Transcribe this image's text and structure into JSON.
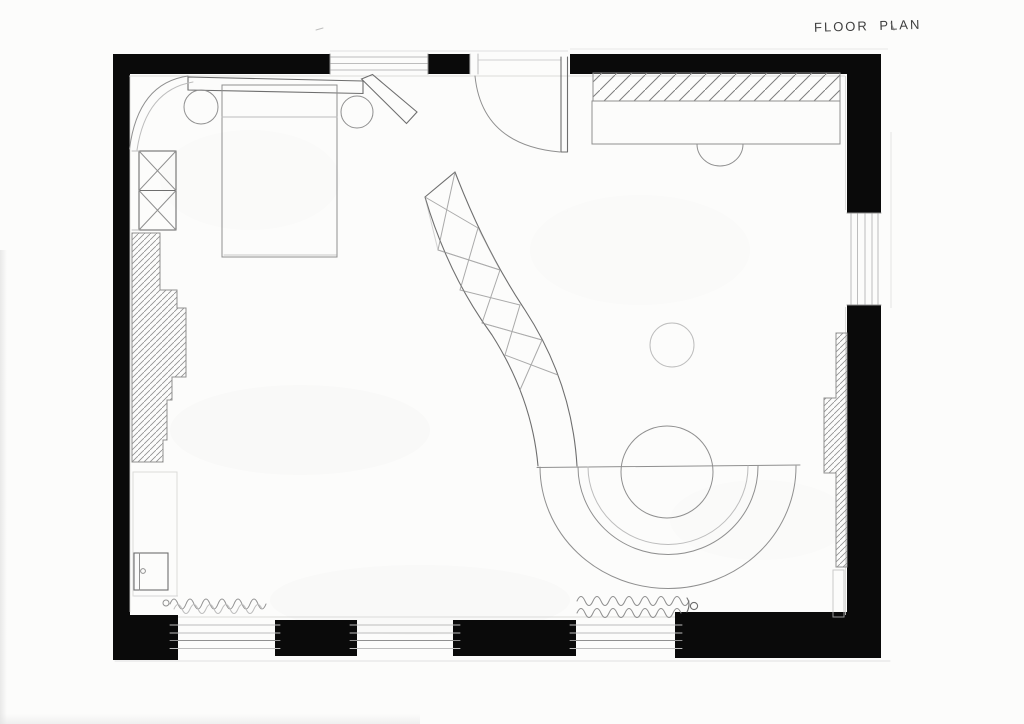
{
  "page": {
    "title_annotation": "FLOOR PLAN"
  },
  "palette": {
    "wall": "#0a0a0a",
    "pencil": "#8f8f8f",
    "pencil_dark": "#6e6e6e",
    "pencil_light": "#bdbdbd",
    "paper": "#fcfcfb",
    "ink": "#3f3f3f"
  },
  "plan": {
    "drawing_type": "hand-drawn pencil floor plan, plan view",
    "elements": [
      {
        "name": "exterior-walls",
        "style": "solid black poche"
      },
      {
        "name": "entry-door",
        "location": "top wall, center, quarter-circle swing"
      },
      {
        "name": "window-top",
        "location": "top wall left of door"
      },
      {
        "name": "window-right",
        "location": "right wall upper"
      },
      {
        "name": "window-bottom-left",
        "location": "bottom wall"
      },
      {
        "name": "window-bottom-center",
        "location": "bottom wall"
      },
      {
        "name": "window-bottom-right",
        "location": "bottom wall"
      },
      {
        "name": "bed",
        "location": "top left"
      },
      {
        "name": "headboard-with-angled-wing",
        "location": "top left"
      },
      {
        "name": "bedside-table-left",
        "shape": "circle"
      },
      {
        "name": "bedside-table-right",
        "shape": "circle"
      },
      {
        "name": "canopy-screen-arc",
        "location": "top left corner"
      },
      {
        "name": "crossed-storage-unit",
        "location": "left wall, two X boxes"
      },
      {
        "name": "built-in-unit-left",
        "style": "stepped, diagonal hatch"
      },
      {
        "name": "alcove-outline",
        "location": "left wall below built-in"
      },
      {
        "name": "small-cabinet",
        "location": "bottom left corner"
      },
      {
        "name": "radiator-left",
        "style": "squiggle coil"
      },
      {
        "name": "radiator-right",
        "style": "double squiggle coil"
      },
      {
        "name": "desk-counter",
        "location": "top right",
        "style": "hatched band + front"
      },
      {
        "name": "desk-chair",
        "shape": "semicircle"
      },
      {
        "name": "side-table",
        "shape": "small circle, mid right"
      },
      {
        "name": "curved-partition",
        "style": "curved band with X bracing"
      },
      {
        "name": "round-table",
        "location": "lower middle"
      },
      {
        "name": "semicircular-banquette",
        "style": "three concentric arcs"
      },
      {
        "name": "built-in-unit-right",
        "style": "stepped, diagonal hatch"
      }
    ]
  }
}
